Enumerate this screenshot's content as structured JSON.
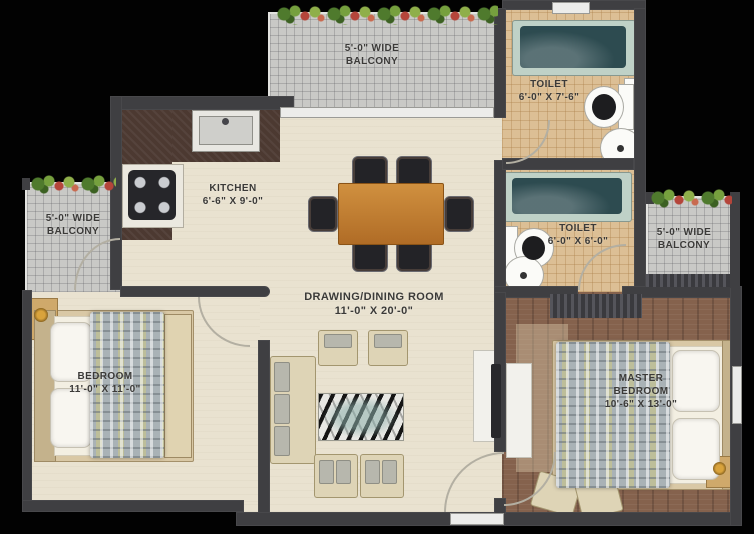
{
  "rooms": {
    "balcony_top": {
      "line1": "5'-0\" WIDE",
      "line2": "BALCONY"
    },
    "balcony_left": {
      "line1": "5'-0\" WIDE",
      "line2": "BALCONY"
    },
    "balcony_right": {
      "line1": "5'-0\" WIDE",
      "line2": "BALCONY"
    },
    "toilet_top": {
      "line1": "TOILET",
      "line2": "6'-0\" X 7'-6\""
    },
    "toilet_mid": {
      "line1": "TOILET",
      "line2": "6'-0\" X 6'-0\""
    },
    "kitchen": {
      "line1": "KITCHEN",
      "line2": "6'-6\" X 9'-0\""
    },
    "drawing_dining": {
      "line1": "DRAWING/DINING ROOM",
      "line2": "11'-0\" X 20'-0\""
    },
    "bedroom": {
      "line1": "BEDROOM",
      "line2": "11'-0\" X 11'-0\""
    },
    "master_bedroom": {
      "line1": "MASTER",
      "line2": "BEDROOM",
      "line3": "10'-6\" X 13'-0\""
    }
  },
  "colors": {
    "background": "#020202",
    "wall": "#3f3f42",
    "floor_cream": "#e9e2d0",
    "balcony_tile": "#c9c9c6",
    "toilet_tile": "#dcbf95",
    "wood_floor": "#85624d",
    "counter": "#4c3931",
    "dining_table": "#c0803a",
    "bathtub": "#2d4b50",
    "label_text": "#3b3a38"
  }
}
